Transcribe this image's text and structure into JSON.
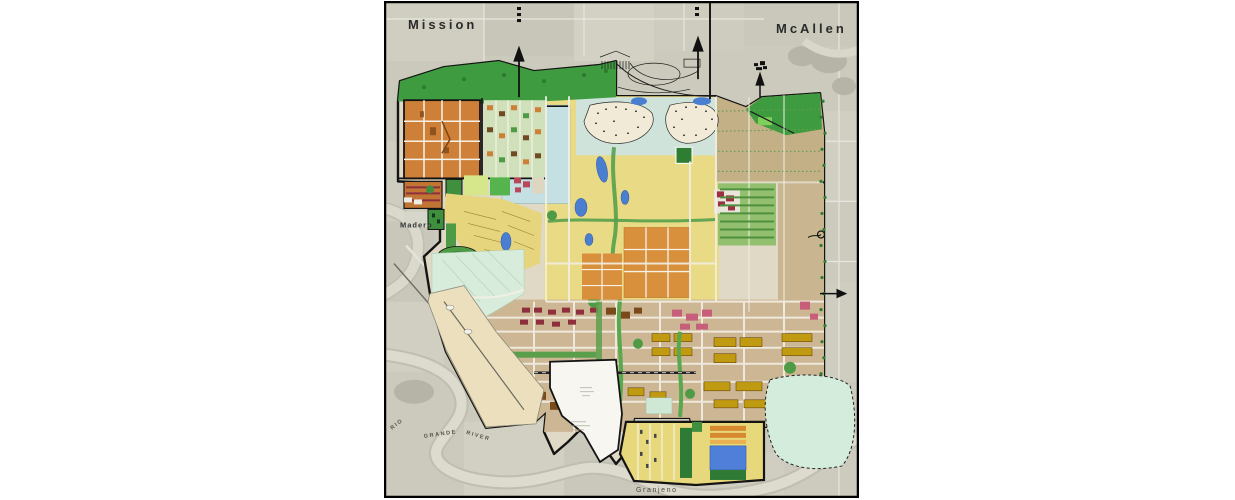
{
  "map": {
    "labels": {
      "city_left": "Mission",
      "city_right": "McAllen",
      "town_madero": "Madero",
      "town_granjeno": "Granjeno",
      "river_word1": "RIO",
      "river_word2": "GRANDE",
      "river_word3": "RIVER"
    },
    "colors": {
      "aerial_base": "#cbcabc",
      "parkland_green": "#3f9b3f",
      "residential_yellow": "#e9da85",
      "residential_orange": "#cf8038",
      "water_blue": "#4a7ed0",
      "lake_pale": "#c4e0e2",
      "mint_overlay": "#d6ecdc",
      "commercial_tan": "#ccb694",
      "civic_maroon": "#8e2f3e",
      "industrial_olive": "#c09a10",
      "levee_cream": "#ecdfbd",
      "boundary_black": "#141414"
    }
  }
}
